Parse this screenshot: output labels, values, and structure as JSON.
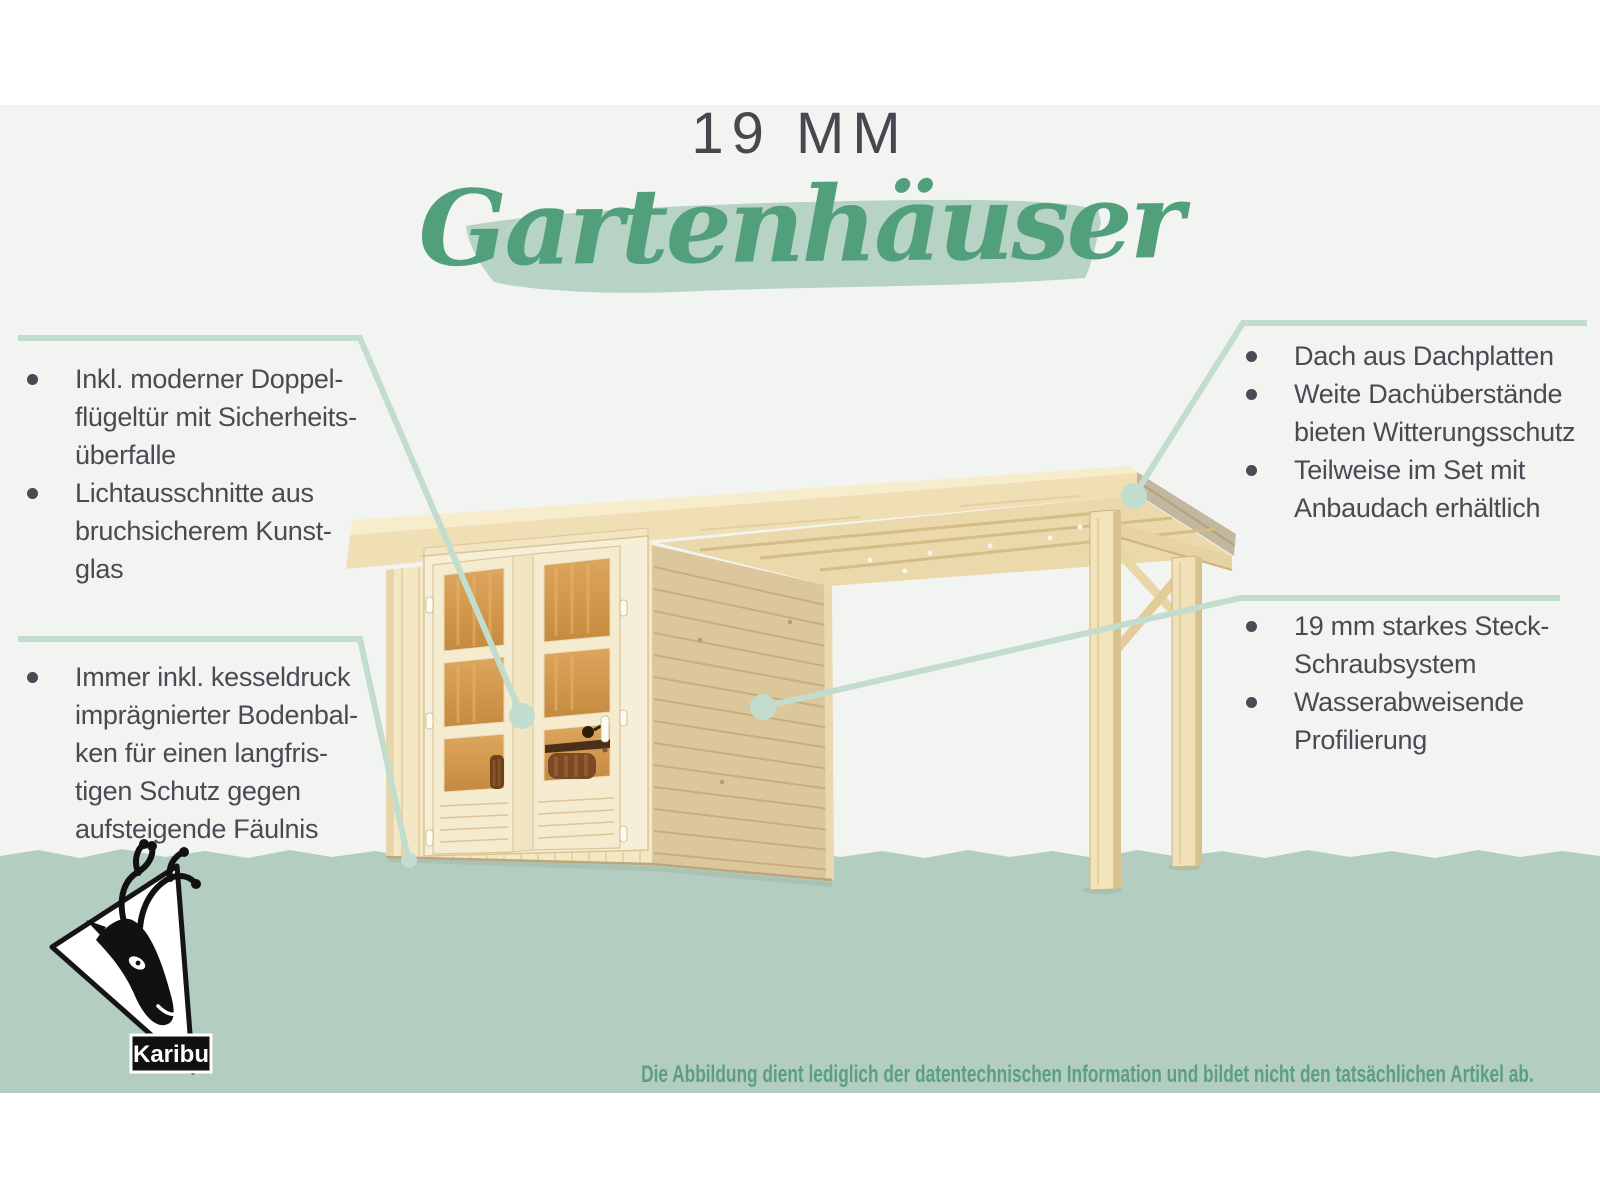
{
  "header": {
    "subtitle": "19 MM",
    "title": "Gartenhäuser"
  },
  "features": {
    "door": {
      "items": [
        "Inkl. moderner Doppel-\nflügeltür mit Sicherheits-\nüberfalle",
        "Lichtausschnitte aus\nbruchsicherem Kunst-\nglas"
      ]
    },
    "floor": {
      "items": [
        "Immer inkl. kesseldruck\nimprägnierter Bodenbal-\nken für einen langfris-\ntigen Schutz gegen\naufsteigende Fäulnis"
      ]
    },
    "roof": {
      "items": [
        "Dach aus Dachplatten",
        "Weite Dachüberstände\nbieten Witterungsschutz",
        "Teilweise im Set mit\nAnbaudach erhältlich"
      ]
    },
    "walls": {
      "items": [
        "19 mm starkes Steck-\nSchraubsystem",
        "Wasserabweisende\nProfilierung"
      ]
    }
  },
  "footer": {
    "disclaimer": "Die Abbildung dient lediglich der datentechnischen Information und bildet nicht den tatsächlichen Artikel ab.",
    "logo_text": "Karibu"
  },
  "colors": {
    "accent_green": "#52a07b",
    "brush_green": "#b7d3c5",
    "band_green": "#b3cec0",
    "callout_green": "#c2dcce",
    "text_dark": "#4a4a54",
    "disclaimer_green": "#5c9f81"
  }
}
